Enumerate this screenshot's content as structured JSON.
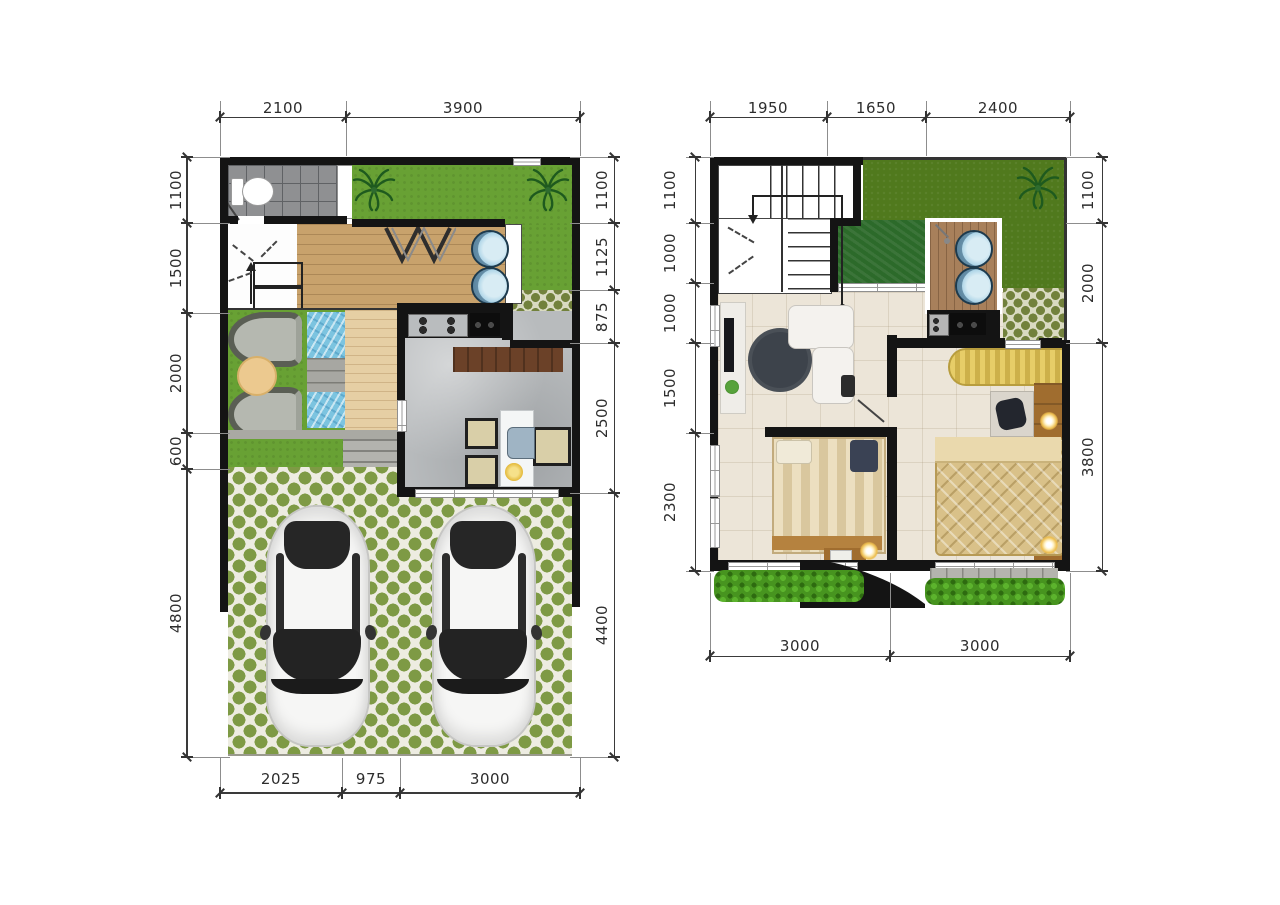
{
  "sheet": {
    "type": "house-floor-plan",
    "panels": [
      "ground-floor-plan",
      "upper-floor-plan"
    ]
  },
  "plans": [
    {
      "name": "ground-floor-plan",
      "top_dims": [
        "2100",
        "3900"
      ],
      "left_dims": [
        "1100",
        "1500",
        "2000",
        "600",
        "4800"
      ],
      "right_dims": [
        "1100",
        "1125",
        "875",
        "2500",
        "4400"
      ],
      "bottom_dims": [
        "2025",
        "975",
        "3000"
      ]
    },
    {
      "name": "upper-floor-plan",
      "top_dims": [
        "1950",
        "1650",
        "2400"
      ],
      "left_dims": [
        "1100",
        "1000",
        "1000",
        "1500",
        "2300"
      ],
      "right_dims": [
        "1100",
        "2000",
        "3800"
      ],
      "bottom_dims": [
        "3000",
        "3000"
      ]
    }
  ],
  "icons": {
    "palm_tree": "radiating-leaf glyph",
    "toilet": "tank-and-bowl glyph",
    "shower": "diagonal-sprayer glyph",
    "zigzag_partition": "W-shaped divider glyph",
    "direction_arrow": "entry/stair arrow glyph",
    "car": "top-view sedan glyph"
  },
  "colors": {
    "wall": "#141414",
    "dim_text": "#2d2d2d",
    "grass_bright": "#68a134",
    "grass_dark": "#50791d",
    "grass_patch": "#2c6a2a",
    "paver_olive": "#7e9a45",
    "deck_wood": "#c8a26c",
    "bath_tile": "#8f9092",
    "marble_floor": "#b8bbbd",
    "cream_tile": "#ece5d8",
    "water": "#7cc4e0",
    "wardrobe_gold": "#dcc25e",
    "counter_black": "#141414",
    "bedding_gold": "#d9c189"
  }
}
